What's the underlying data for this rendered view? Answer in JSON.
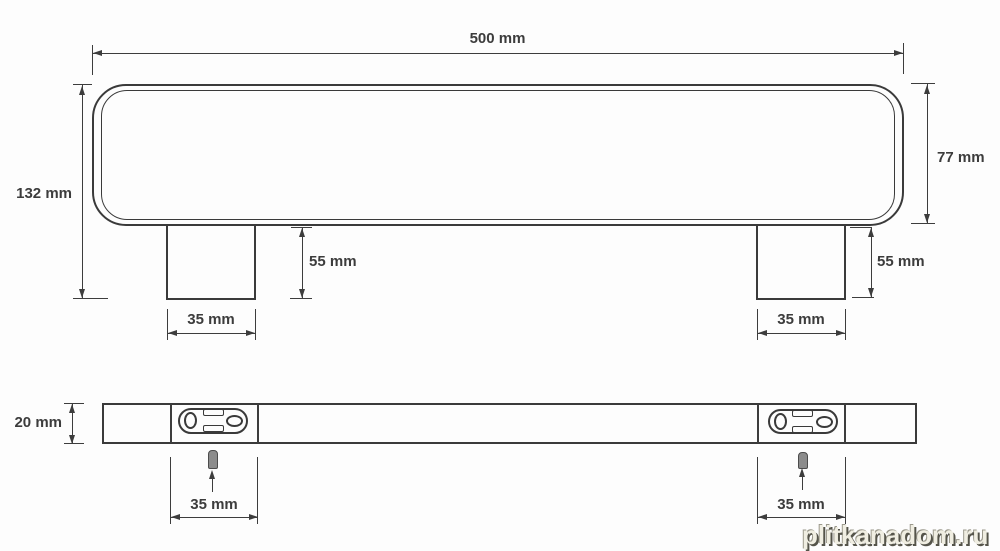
{
  "front_view": {
    "overall_width_label": "500 mm",
    "overall_height_label": "132 mm",
    "body_height_label": "77 mm",
    "leg_height_left_label": "55 mm",
    "leg_height_right_label": "55 mm",
    "leg_width_left_label": "35 mm",
    "leg_width_right_label": "35 mm"
  },
  "bottom_view": {
    "depth_label": "20 mm",
    "plate_width_left_label": "35 mm",
    "plate_width_right_label": "35 mm"
  },
  "watermark": {
    "text": "plitkanadom.ru"
  },
  "colors": {
    "line": "#3d3d3d",
    "text": "#3c3c3c",
    "watermark_fill": "#f0eee2",
    "watermark_shadow": "#55544a"
  }
}
